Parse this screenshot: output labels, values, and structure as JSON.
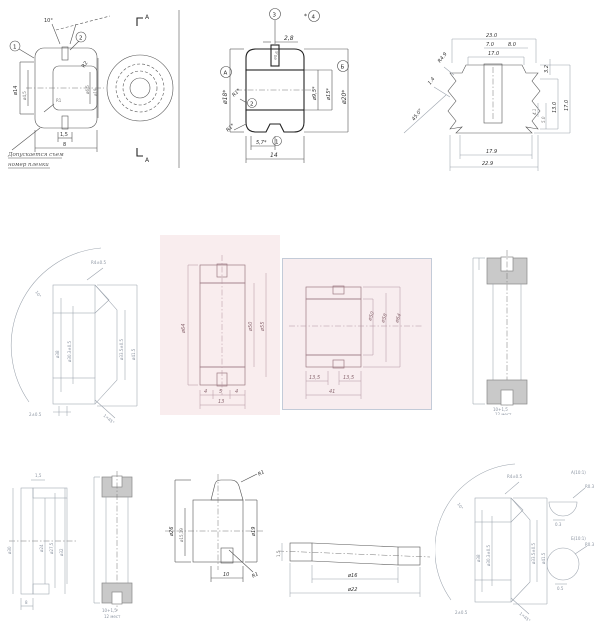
{
  "page": {
    "background": "#ffffff",
    "description": "collage of rubber grommet engineering cross-section drawings"
  },
  "drawings": {
    "d1": {
      "angle_top": "10°",
      "callout_left": "1",
      "callout_right": "2",
      "dia_left_outer": "ø14",
      "dia_left_inner": "ø4,5",
      "r_top": "R2",
      "dia_hole": "ø6,5",
      "dia_outer": "ø19",
      "r_groove": "R1",
      "dim_groove": "1,5",
      "dim_width": "8",
      "section_mark_top": "A",
      "section_mark_bottom": "A",
      "note_line1": "Допускается съем",
      "note_line2": "номер пленки"
    },
    "d2": {
      "dim_top": "2,8",
      "dia_slot": "ø0,6",
      "dia_left": "ø18*",
      "callout_a": "А",
      "callout_3": "3",
      "callout_4": "4",
      "callout_2": "2",
      "callout_1": "1",
      "callout_b": "Б",
      "r1_mid": "R1*",
      "r1_low": "R1*",
      "dim_57": "5,7*",
      "dim_14": "14",
      "dia_95": "ø9,5*",
      "dia_15": "ø15*",
      "dia_20": "ø20*"
    },
    "d3": {
      "top_total": "23.0",
      "top_slot": "7.0",
      "top_right": "8.0",
      "top_inner": "17.0",
      "left_r": "R4.9",
      "left_t": "1.4",
      "left_angle": "45.0°",
      "r_32": "3.2",
      "r_41": "4.1",
      "r_50": "5.0",
      "r_130": "13.0",
      "r_170": "17.0",
      "bot_inner": "17.9",
      "bot_total": "22.9"
    },
    "d4": {
      "angle": "10°",
      "r": "R4±0.5",
      "dia1": "ø38",
      "dia2": "ø30.3±0.5",
      "dia3": "ø33.5±0.5",
      "dia4": "ø41.5",
      "b1": "2±0.5",
      "b2": "1×45°"
    },
    "d5": {
      "dia_out": "ø64",
      "dia_in": "ø50",
      "dia_mid": "ø55",
      "b1": "4",
      "b2": "5",
      "b3": "4",
      "b_total": "13"
    },
    "d6": {
      "dia_in": "ø50",
      "dia_mid": "ø58",
      "dia_out": "ø64",
      "b_left": "13,5",
      "b_right": "13,5",
      "b_total": "41"
    },
    "d7": {
      "note1": "10+1,5",
      "note2": "12 мест"
    },
    "d8": {
      "top": "1,5",
      "dia_left": "ø30",
      "dia_a": "ø24",
      "dia_b": "ø27,5",
      "dia_c": "ø32",
      "bottom": "8"
    },
    "d9": {
      "note1": "10+1,5",
      "note2": "12 мест"
    },
    "d10": {
      "r_top": "R1",
      "dia_out": "ø26",
      "dia_in": "ø15,19",
      "dia_right": "ø19",
      "width": "10",
      "r_bot": "R1"
    },
    "d11": {
      "dia_in": "ø16",
      "dia_out": "ø22",
      "thickness": "1,5"
    },
    "d12": {
      "angle": "10°",
      "r": "R4±0.5",
      "dia1": "ø38",
      "dia2": "ø30.3±0.5",
      "dia3": "ø33.5±0.5",
      "dia4": "ø41.5",
      "b1": "2±0.5",
      "b2": "1×45°",
      "detail_a": "А(10:1)",
      "detail_b": "Б(10:1)",
      "a_r": "R0.3",
      "a_d": "0.3",
      "b_r": "R0.3",
      "b_d": "0.5"
    }
  }
}
